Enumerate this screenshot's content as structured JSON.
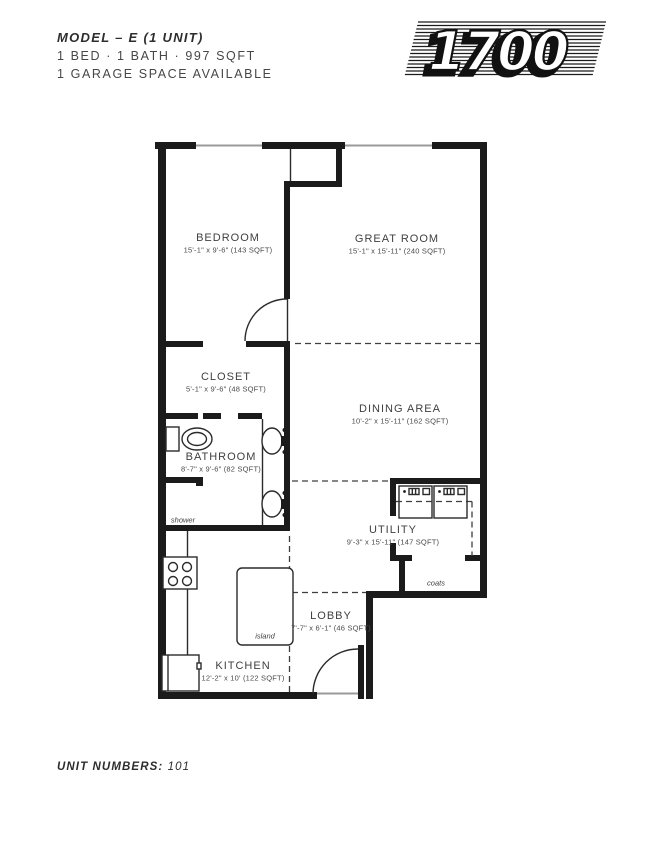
{
  "header": {
    "model_title": "MODEL – E (1 UNIT)",
    "specs_line": "1 BED · 1 BATH · 997 SQFT",
    "garage_line": "1 GARAGE SPACE AVAILABLE",
    "logo_number": "1700"
  },
  "floor_plan": {
    "rooms": [
      {
        "name": "BEDROOM",
        "dims": "15'-1\" x 9'-6\" (143 SQFT)"
      },
      {
        "name": "GREAT ROOM",
        "dims": "15'-1\" x 15'-11\" (240 SQFT)"
      },
      {
        "name": "CLOSET",
        "dims": "5'-1\" x 9'-6\" (48 SQFT)"
      },
      {
        "name": "BATHROOM",
        "dims": "8'-7\" x 9'-6\" (82 SQFT)"
      },
      {
        "name": "DINING AREA",
        "dims": "10'-2\" x 15'-11\" (162 SQFT)"
      },
      {
        "name": "UTILITY",
        "dims": "9'-3\" x 15'-11\" (147 SQFT)"
      },
      {
        "name": "LOBBY",
        "dims": "7'-7\" x 6'-1\" (46 SQFT)"
      },
      {
        "name": "KITCHEN",
        "dims": "12'-2\" x 10' (122 SQFT)"
      }
    ],
    "annotations": {
      "shower": "shower",
      "island": "island",
      "coats": "coats"
    }
  },
  "footer": {
    "unit_numbers_label": "UNIT NUMBERS:",
    "unit_numbers_value": "101"
  },
  "colors": {
    "wall": "#1b1b1b",
    "text": "#3f3f3f",
    "window": "#9a9a9a"
  }
}
